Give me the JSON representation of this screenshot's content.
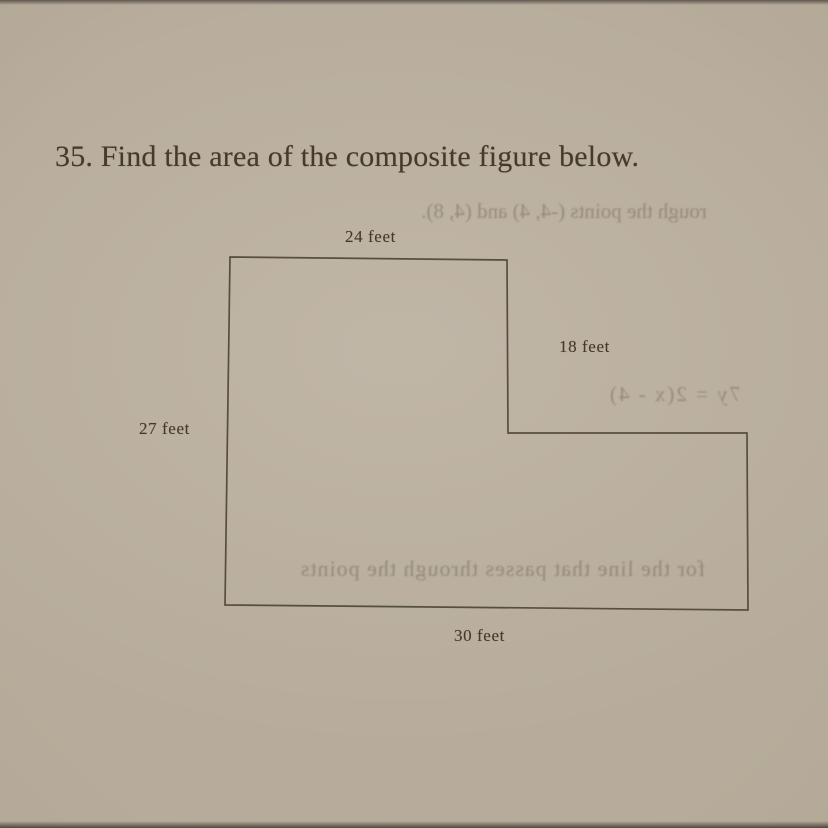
{
  "problem": {
    "title": "35. Find the area of the composite figure below."
  },
  "figure": {
    "type": "L-shaped composite figure",
    "labels": {
      "top": "24 feet",
      "right": "18 feet",
      "left": "27 feet",
      "bottom": "30 feet"
    },
    "dimensions_feet": {
      "top_width": 24,
      "right_upper_height": 18,
      "left_height": 27,
      "bottom_width": 30
    },
    "outline_color": "#4e453a"
  },
  "ghost_text": {
    "line1": "rough the points (-4, 4) and (4, 8).",
    "line2": "7y = 2(x - 4)",
    "line3": "for the line that passes through the points"
  },
  "colors": {
    "paper": "#b2a796",
    "ink": "#453a2c"
  }
}
